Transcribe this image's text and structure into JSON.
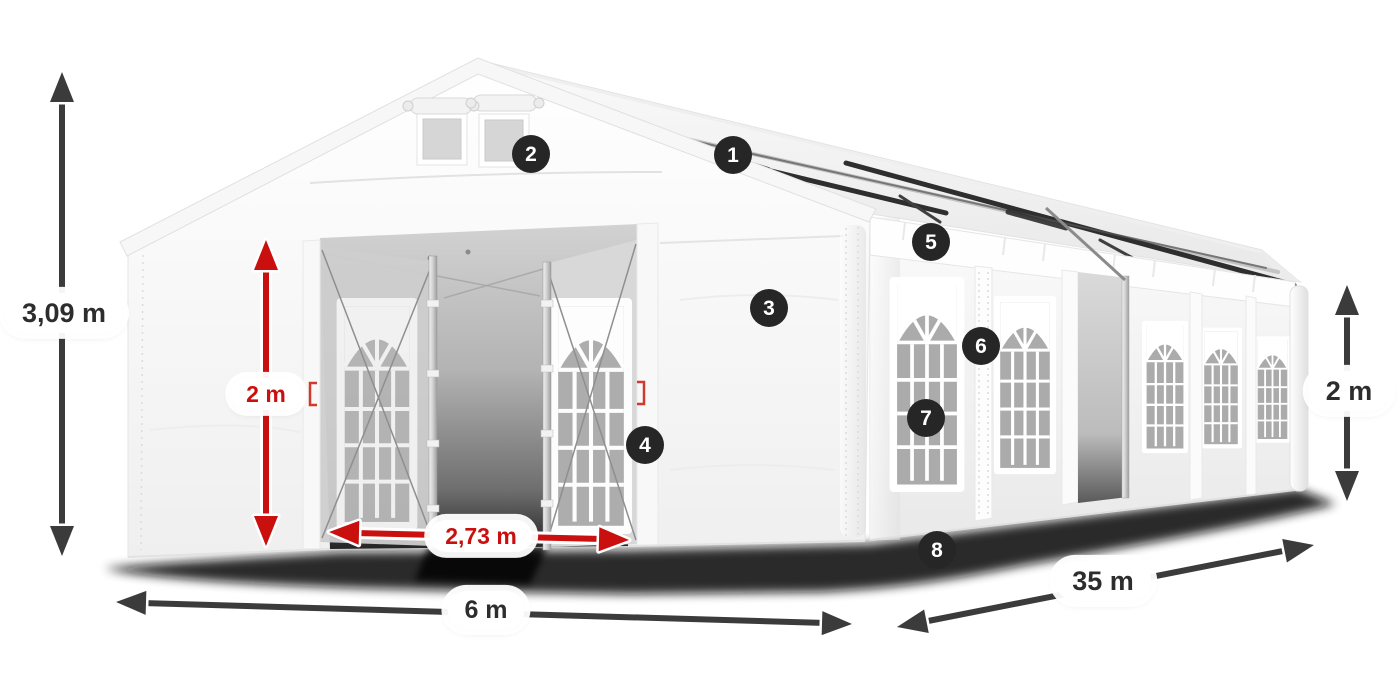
{
  "diagram": {
    "measurements": {
      "total_height": "3,09 m",
      "entrance_height": "2 m",
      "entrance_width": "2,73 m",
      "front_width": "6 m",
      "side_length": "35 m",
      "side_wall_height": "2 m"
    },
    "callouts": [
      "1",
      "2",
      "3",
      "4",
      "5",
      "6",
      "7",
      "8"
    ],
    "colors": {
      "accent": "#c9100f",
      "ink": "#2d2d2d",
      "arrow_dark": "#3b3b3b",
      "badge_bg": "#262626",
      "badge_text": "#ffffff",
      "canvas_bg": "#ffffff"
    }
  }
}
